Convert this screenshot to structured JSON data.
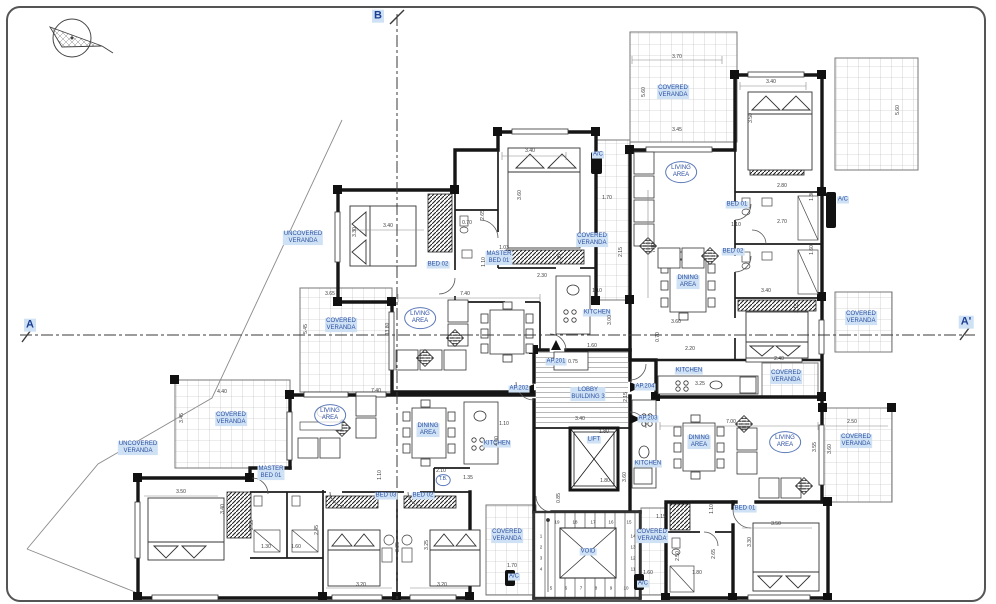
{
  "drawing": {
    "type": "architectural floor plan",
    "building": "BUILDING 3",
    "colors": {
      "label_text": "#2b4fa0",
      "label_highlight": "#cfe2f5",
      "wall": "#161616",
      "dimension_text": "#3a3a3a",
      "section_line": "#3a3a3a"
    },
    "labels": [
      {
        "kind": "tag",
        "lines": [
          "COVERED",
          "VERANDA"
        ],
        "x": 673,
        "y": 92
      },
      {
        "kind": "oval",
        "lines": [
          "LIVING",
          "AREA"
        ],
        "x": 681,
        "y": 172
      },
      {
        "kind": "tag",
        "lines": [
          "BED 01"
        ],
        "x": 737,
        "y": 205
      },
      {
        "kind": "tag",
        "lines": [
          "BED 02"
        ],
        "x": 733,
        "y": 252
      },
      {
        "kind": "tag",
        "lines": [
          "DINING",
          "AREA"
        ],
        "x": 688,
        "y": 282
      },
      {
        "kind": "tag",
        "lines": [
          "COVERED",
          "VERANDA"
        ],
        "x": 592,
        "y": 240
      },
      {
        "kind": "tag",
        "lines": [
          "A/C"
        ],
        "x": 598,
        "y": 155
      },
      {
        "kind": "tag",
        "lines": [
          "A/C"
        ],
        "x": 843,
        "y": 200
      },
      {
        "kind": "tag",
        "lines": [
          "UNCOVERED",
          "VERANDA"
        ],
        "x": 303,
        "y": 238
      },
      {
        "kind": "tag",
        "lines": [
          "BED 02"
        ],
        "x": 438,
        "y": 265
      },
      {
        "kind": "tag",
        "lines": [
          "MASTER",
          "BED 01"
        ],
        "x": 499,
        "y": 258
      },
      {
        "kind": "oval",
        "lines": [
          "LIVING",
          "AREA"
        ],
        "x": 420,
        "y": 318
      },
      {
        "kind": "tag",
        "lines": [
          "KITCHEN"
        ],
        "x": 597,
        "y": 313
      },
      {
        "kind": "tag",
        "lines": [
          "COVERED",
          "VERANDA"
        ],
        "x": 341,
        "y": 325
      },
      {
        "kind": "tag",
        "lines": [
          "UNCOVERED",
          "VERANDA"
        ],
        "x": 138,
        "y": 448
      },
      {
        "kind": "tag",
        "lines": [
          "COVERED",
          "VERANDA"
        ],
        "x": 231,
        "y": 419
      },
      {
        "kind": "oval",
        "lines": [
          "LIVING",
          "AREA"
        ],
        "x": 330,
        "y": 415
      },
      {
        "kind": "tag",
        "lines": [
          "DINING",
          "AREA"
        ],
        "x": 428,
        "y": 430
      },
      {
        "kind": "tag",
        "lines": [
          "KITCHEN"
        ],
        "x": 497,
        "y": 444
      },
      {
        "kind": "tag",
        "lines": [
          "MASTER",
          "BED 01"
        ],
        "x": 271,
        "y": 473
      },
      {
        "kind": "tag",
        "lines": [
          "BED 03"
        ],
        "x": 386,
        "y": 496
      },
      {
        "kind": "tag",
        "lines": [
          "BED 02"
        ],
        "x": 423,
        "y": 496
      },
      {
        "kind": "circle",
        "lines": [
          "T.B."
        ],
        "x": 443,
        "y": 480
      },
      {
        "kind": "door",
        "lines": [
          "AP.201"
        ],
        "x": 556,
        "y": 362
      },
      {
        "kind": "door",
        "lines": [
          "AP.202"
        ],
        "x": 519,
        "y": 389
      },
      {
        "kind": "door",
        "lines": [
          "AP.204"
        ],
        "x": 645,
        "y": 387
      },
      {
        "kind": "door",
        "lines": [
          "AP.203"
        ],
        "x": 648,
        "y": 419
      },
      {
        "kind": "core",
        "lines": [
          "LOBBY",
          "BUILDING 3"
        ],
        "x": 588,
        "y": 394
      },
      {
        "kind": "core",
        "lines": [
          "LIFT"
        ],
        "x": 594,
        "y": 440
      },
      {
        "kind": "core",
        "lines": [
          "VOID"
        ],
        "x": 588,
        "y": 552
      },
      {
        "kind": "tag",
        "lines": [
          "COVERED",
          "VERANDA"
        ],
        "x": 507,
        "y": 536
      },
      {
        "kind": "tag",
        "lines": [
          "COVERED",
          "VERANDA"
        ],
        "x": 652,
        "y": 536
      },
      {
        "kind": "tag",
        "lines": [
          "A/C"
        ],
        "x": 514,
        "y": 577
      },
      {
        "kind": "tag",
        "lines": [
          "A/C"
        ],
        "x": 643,
        "y": 584
      },
      {
        "kind": "tag",
        "lines": [
          "KITCHEN"
        ],
        "x": 689,
        "y": 371
      },
      {
        "kind": "tag",
        "lines": [
          "COVERED",
          "VERANDA"
        ],
        "x": 786,
        "y": 377
      },
      {
        "kind": "tag",
        "lines": [
          "KITCHEN"
        ],
        "x": 648,
        "y": 464
      },
      {
        "kind": "tag",
        "lines": [
          "DINING",
          "AREA"
        ],
        "x": 699,
        "y": 442
      },
      {
        "kind": "oval",
        "lines": [
          "LIVING",
          "AREA"
        ],
        "x": 785,
        "y": 442
      },
      {
        "kind": "tag",
        "lines": [
          "COVERED",
          "VERANDA"
        ],
        "x": 856,
        "y": 441
      },
      {
        "kind": "tag",
        "lines": [
          "BED 01"
        ],
        "x": 745,
        "y": 509
      },
      {
        "kind": "tag",
        "lines": [
          "COVERED",
          "VERANDA"
        ],
        "x": 861,
        "y": 318
      },
      {
        "kind": "section",
        "lines": [
          "A"
        ],
        "x": 30,
        "y": 325
      },
      {
        "kind": "section",
        "lines": [
          "A'"
        ],
        "x": 966,
        "y": 322
      },
      {
        "kind": "section",
        "lines": [
          "B"
        ],
        "x": 378,
        "y": 16
      }
    ],
    "dimensions": [
      {
        "t": "3.70",
        "x": 677,
        "y": 57
      },
      {
        "t": "5.60",
        "x": 644,
        "y": 92,
        "r": 90
      },
      {
        "t": "3.45",
        "x": 677,
        "y": 130
      },
      {
        "t": "3.40",
        "x": 771,
        "y": 82
      },
      {
        "t": "3.50",
        "x": 751,
        "y": 118,
        "r": 90
      },
      {
        "t": "2.80",
        "x": 782,
        "y": 186
      },
      {
        "t": "1.30",
        "x": 812,
        "y": 196,
        "r": 90
      },
      {
        "t": "2.70",
        "x": 782,
        "y": 222
      },
      {
        "t": "1.60",
        "x": 812,
        "y": 250,
        "r": 90
      },
      {
        "t": "1.10",
        "x": 736,
        "y": 225
      },
      {
        "t": "1.70",
        "x": 607,
        "y": 198
      },
      {
        "t": "2.15",
        "x": 621,
        "y": 252,
        "r": 90
      },
      {
        "t": "7.40",
        "x": 654,
        "y": 248,
        "r": 90
      },
      {
        "t": "3.40",
        "x": 766,
        "y": 291
      },
      {
        "t": "3.15",
        "x": 797,
        "y": 308,
        "r": 90
      },
      {
        "t": "2.40",
        "x": 779,
        "y": 359
      },
      {
        "t": "3.60",
        "x": 676,
        "y": 322
      },
      {
        "t": "2.20",
        "x": 690,
        "y": 349
      },
      {
        "t": "0.70",
        "x": 658,
        "y": 337,
        "r": 90
      },
      {
        "t": "3.25",
        "x": 700,
        "y": 384
      },
      {
        "t": "7.40",
        "x": 465,
        "y": 294
      },
      {
        "t": "3.40",
        "x": 388,
        "y": 226
      },
      {
        "t": "3.30",
        "x": 355,
        "y": 232,
        "r": 90
      },
      {
        "t": "3.40",
        "x": 530,
        "y": 151
      },
      {
        "t": "3.60",
        "x": 520,
        "y": 195,
        "r": 90
      },
      {
        "t": "2.65",
        "x": 483,
        "y": 215,
        "r": 90
      },
      {
        "t": "0.70",
        "x": 467,
        "y": 223
      },
      {
        "t": "1.03",
        "x": 504,
        "y": 248
      },
      {
        "t": "1.10",
        "x": 484,
        "y": 262,
        "r": 90
      },
      {
        "t": "2.30",
        "x": 542,
        "y": 276
      },
      {
        "t": "1.35",
        "x": 560,
        "y": 259,
        "r": 90
      },
      {
        "t": "1.10",
        "x": 597,
        "y": 291
      },
      {
        "t": "3.00",
        "x": 610,
        "y": 320,
        "r": 90
      },
      {
        "t": "1.60",
        "x": 592,
        "y": 346
      },
      {
        "t": "0.75",
        "x": 573,
        "y": 362
      },
      {
        "t": "3.65",
        "x": 330,
        "y": 294
      },
      {
        "t": "5.45",
        "x": 306,
        "y": 329,
        "r": 90
      },
      {
        "t": "13.80",
        "x": 388,
        "y": 329,
        "r": 90
      },
      {
        "t": "4.40",
        "x": 222,
        "y": 392
      },
      {
        "t": "3.45",
        "x": 182,
        "y": 418,
        "r": 90
      },
      {
        "t": "7.40",
        "x": 376,
        "y": 391
      },
      {
        "t": "3.40",
        "x": 580,
        "y": 419
      },
      {
        "t": "2.15",
        "x": 626,
        "y": 397,
        "r": 90
      },
      {
        "t": "1.10",
        "x": 504,
        "y": 424
      },
      {
        "t": "4.00",
        "x": 497,
        "y": 441,
        "r": 90
      },
      {
        "t": "2.10",
        "x": 441,
        "y": 471
      },
      {
        "t": "1.35",
        "x": 468,
        "y": 478
      },
      {
        "t": "1.80",
        "x": 604,
        "y": 432
      },
      {
        "t": "1.80",
        "x": 605,
        "y": 481
      },
      {
        "t": "0.85",
        "x": 559,
        "y": 498,
        "r": 90
      },
      {
        "t": "1.70",
        "x": 512,
        "y": 566
      },
      {
        "t": "1.15",
        "x": 661,
        "y": 517
      },
      {
        "t": "3.60",
        "x": 625,
        "y": 477,
        "r": 90
      },
      {
        "t": "2.50",
        "x": 678,
        "y": 556,
        "r": 90
      },
      {
        "t": "1.60",
        "x": 648,
        "y": 573
      },
      {
        "t": "1.80",
        "x": 697,
        "y": 573
      },
      {
        "t": "2.65",
        "x": 714,
        "y": 554,
        "r": 90
      },
      {
        "t": "1.10",
        "x": 712,
        "y": 509,
        "r": 90
      },
      {
        "t": "7.00",
        "x": 731,
        "y": 422
      },
      {
        "t": "2.50",
        "x": 852,
        "y": 422
      },
      {
        "t": "3.60",
        "x": 830,
        "y": 449,
        "r": 90
      },
      {
        "t": "3.55",
        "x": 815,
        "y": 447,
        "r": 90
      },
      {
        "t": "3.50",
        "x": 776,
        "y": 524
      },
      {
        "t": "3.30",
        "x": 750,
        "y": 542,
        "r": 90
      },
      {
        "t": "3.50",
        "x": 181,
        "y": 492
      },
      {
        "t": "3.40",
        "x": 223,
        "y": 509,
        "r": 90
      },
      {
        "t": "2.55",
        "x": 252,
        "y": 525,
        "r": 90
      },
      {
        "t": "1.30",
        "x": 266,
        "y": 547
      },
      {
        "t": "1.60",
        "x": 296,
        "y": 547
      },
      {
        "t": "2.45",
        "x": 317,
        "y": 530,
        "r": 90
      },
      {
        "t": "3.20",
        "x": 361,
        "y": 585
      },
      {
        "t": "3.25",
        "x": 398,
        "y": 547,
        "r": 90
      },
      {
        "t": "3.20",
        "x": 442,
        "y": 585
      },
      {
        "t": "3.25",
        "x": 427,
        "y": 545,
        "r": 90
      },
      {
        "t": "1.10",
        "x": 380,
        "y": 475,
        "r": 90
      },
      {
        "t": "5.60",
        "x": 898,
        "y": 110,
        "r": 90
      }
    ],
    "stair_numbers": [
      {
        "t": "1",
        "x": 541,
        "y": 536
      },
      {
        "t": "2",
        "x": 541,
        "y": 547
      },
      {
        "t": "3",
        "x": 541,
        "y": 558
      },
      {
        "t": "4",
        "x": 541,
        "y": 569
      },
      {
        "t": "5",
        "x": 551,
        "y": 588
      },
      {
        "t": "6",
        "x": 566,
        "y": 588
      },
      {
        "t": "7",
        "x": 581,
        "y": 588
      },
      {
        "t": "8",
        "x": 596,
        "y": 588
      },
      {
        "t": "9",
        "x": 611,
        "y": 588
      },
      {
        "t": "10",
        "x": 626,
        "y": 588
      },
      {
        "t": "11",
        "x": 633,
        "y": 569
      },
      {
        "t": "12",
        "x": 633,
        "y": 558
      },
      {
        "t": "13",
        "x": 633,
        "y": 547
      },
      {
        "t": "14",
        "x": 633,
        "y": 536
      },
      {
        "t": "15",
        "x": 629,
        "y": 522
      },
      {
        "t": "16",
        "x": 611,
        "y": 522
      },
      {
        "t": "17",
        "x": 593,
        "y": 522
      },
      {
        "t": "18",
        "x": 575,
        "y": 522
      },
      {
        "t": "19",
        "x": 557,
        "y": 522
      }
    ]
  }
}
